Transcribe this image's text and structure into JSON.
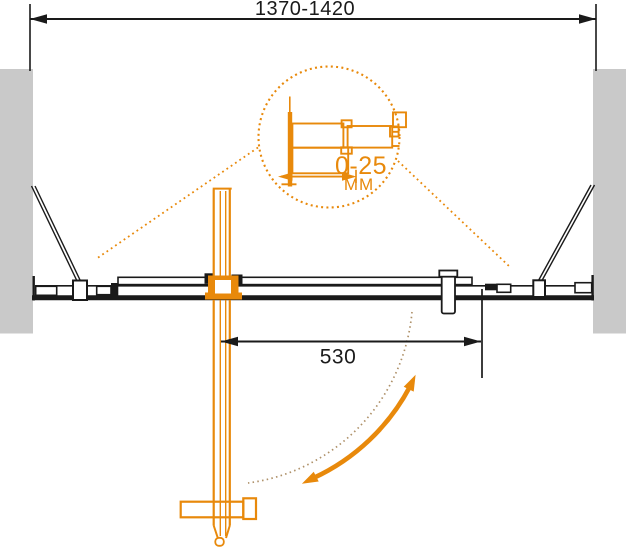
{
  "diagram": {
    "dimensions": {
      "total_width": "1370-1420",
      "door_width": "530",
      "detail_adjustment_range": "0-25",
      "detail_adjustment_unit": "MM"
    },
    "colors": {
      "accent_orange": "#E8890B",
      "wall_gray": "#C9C9C9",
      "line_black": "#1A1A1A",
      "swing_arc_tan": "#AE9068",
      "background": "#FFFFFF"
    }
  }
}
